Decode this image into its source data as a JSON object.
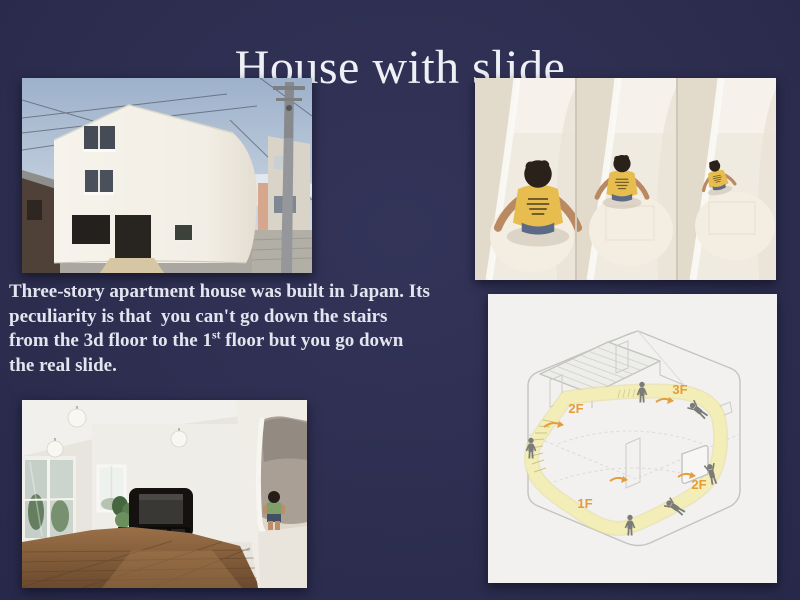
{
  "slide": {
    "title": "House with slide",
    "body_lines": {
      "l1": "Three-story apartment house was built in Japan. Its",
      "l2": "peculiarity is that  you can't go down the stairs",
      "l3_pre": "from the 3d floor to the 1",
      "l3_sup": "st",
      "l3_post": " floor but you go down",
      "l4": "the real slide."
    },
    "diagram": {
      "label_3f": "3F",
      "label_2f_upper": "2F",
      "label_2f_lower": "2F",
      "label_1f": "1F",
      "accent_color": "#e49d3a",
      "slide_path_color": "#f3eeb6",
      "line_color": "#c3c3c0"
    },
    "colors": {
      "background": "#2e2f50",
      "title_text": "#eef0f5",
      "body_text": "#e3e5ee",
      "kid_shirt_yellow": "#e6bd4e",
      "toddler_shirt_green": "#7fa069"
    }
  }
}
